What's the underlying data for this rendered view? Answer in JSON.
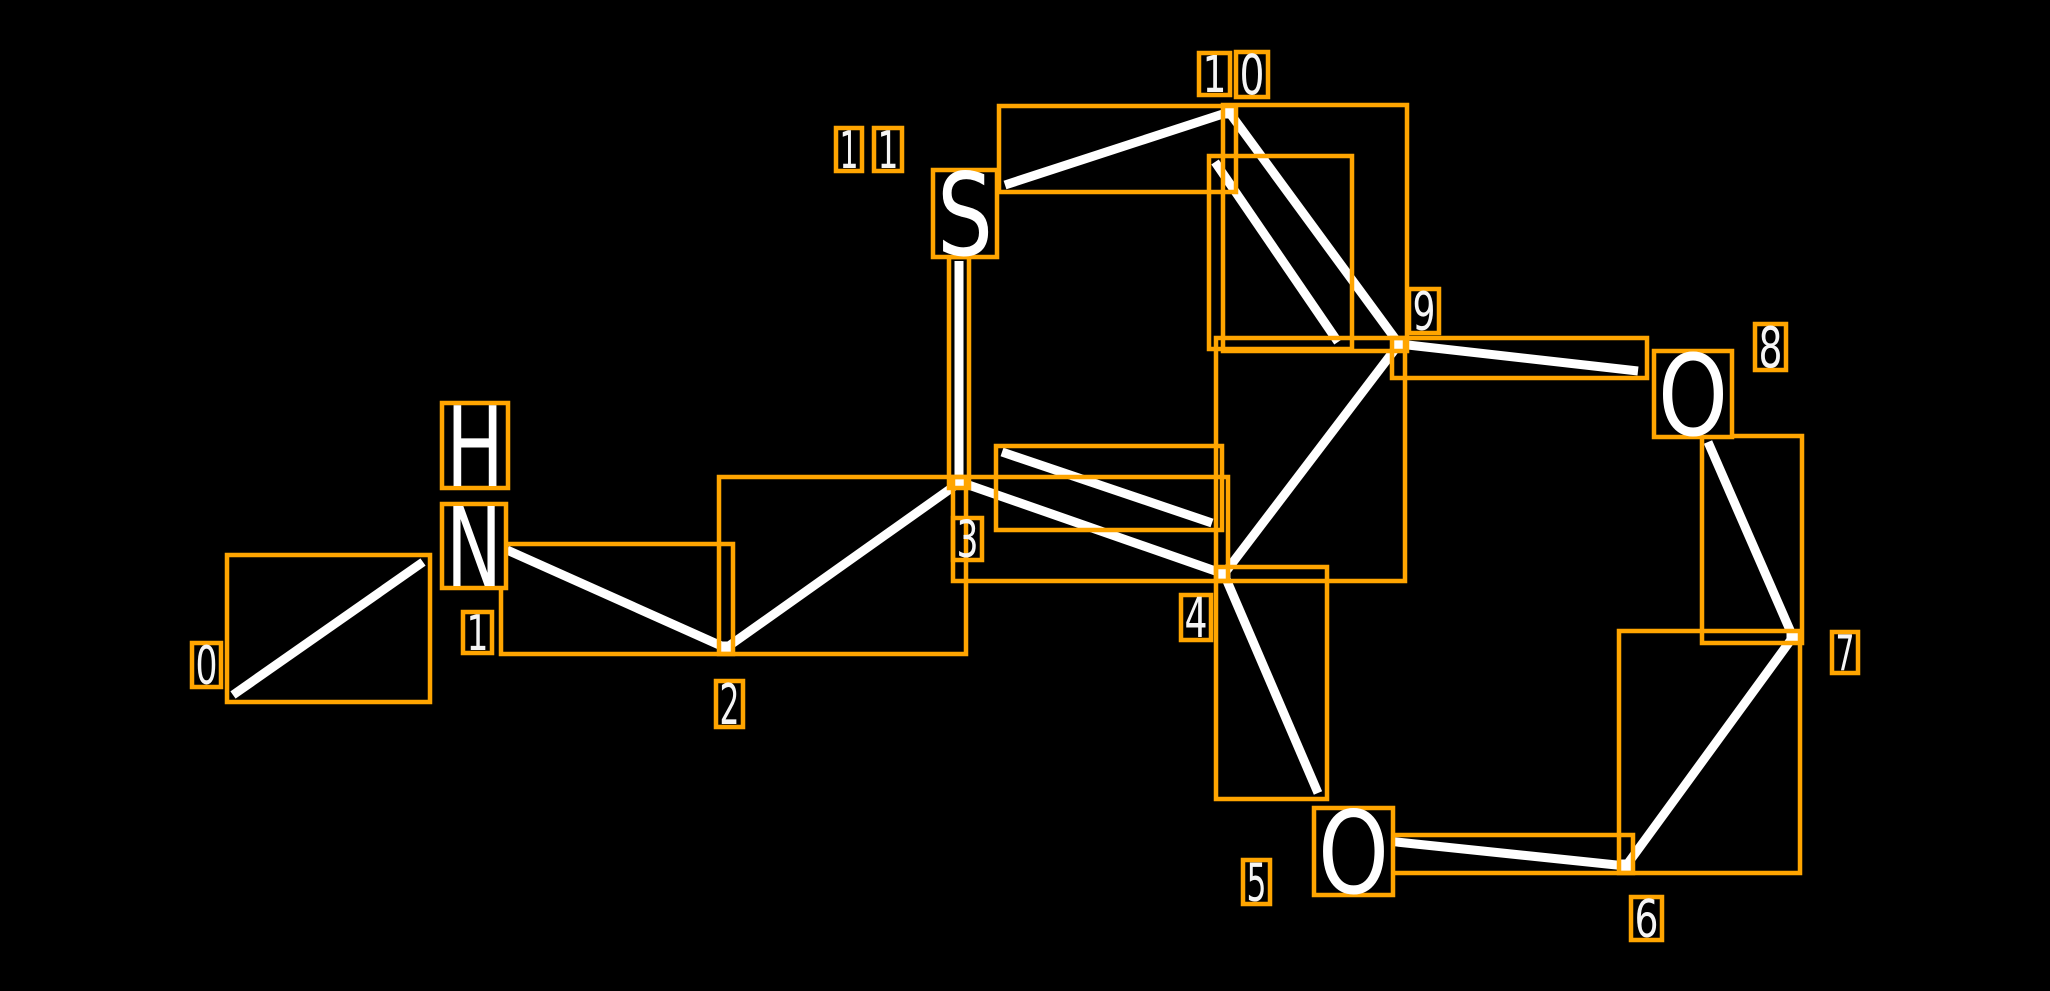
{
  "canvas": {
    "width": 2050,
    "height": 991,
    "background": "#000000"
  },
  "colors": {
    "background": "#000000",
    "bond": "#ffffff",
    "annotation_box": "#ffa500",
    "atom_label": "#ffffff",
    "index_label": "#f5f5f5"
  },
  "style": {
    "bond_stroke_width": 9,
    "box_stroke_width": 4.5,
    "vertex_marker_size": 13
  },
  "molecule": {
    "description": "2D molecular structure drawing with per-bond orange bounding boxes and white atom-index labels 0-11",
    "atoms": [
      {
        "index": 0,
        "element": "C",
        "x": 233,
        "y": 695
      },
      {
        "index": 1,
        "element": "N",
        "x": 474,
        "y": 546,
        "shown_as": "HN"
      },
      {
        "index": 2,
        "element": "C",
        "x": 726,
        "y": 648
      },
      {
        "index": 3,
        "element": "C",
        "x": 960,
        "y": 483
      },
      {
        "index": 4,
        "element": "C",
        "x": 1224,
        "y": 574
      },
      {
        "index": 5,
        "element": "O",
        "x": 1354,
        "y": 851,
        "shown_as": "O"
      },
      {
        "index": 6,
        "element": "C",
        "x": 1626,
        "y": 866
      },
      {
        "index": 7,
        "element": "C",
        "x": 1793,
        "y": 637
      },
      {
        "index": 8,
        "element": "O",
        "x": 1693,
        "y": 394,
        "shown_as": "O"
      },
      {
        "index": 9,
        "element": "C",
        "x": 1399,
        "y": 344
      },
      {
        "index": 10,
        "element": "C",
        "x": 1229,
        "y": 112
      },
      {
        "index": 11,
        "element": "S",
        "x": 965,
        "y": 213,
        "shown_as": "S"
      }
    ],
    "bonds": [
      {
        "from": 0,
        "to": 1,
        "order": "single"
      },
      {
        "from": 1,
        "to": 2,
        "order": "single"
      },
      {
        "from": 2,
        "to": 3,
        "order": "single"
      },
      {
        "from": 3,
        "to": 11,
        "order": "single"
      },
      {
        "from": 3,
        "to": 4,
        "order": "double"
      },
      {
        "from": 11,
        "to": 10,
        "order": "single"
      },
      {
        "from": 10,
        "to": 9,
        "order": "double"
      },
      {
        "from": 9,
        "to": 4,
        "order": "single"
      },
      {
        "from": 9,
        "to": 8,
        "order": "single"
      },
      {
        "from": 8,
        "to": 7,
        "order": "single"
      },
      {
        "from": 7,
        "to": 6,
        "order": "single"
      },
      {
        "from": 6,
        "to": 5,
        "order": "single"
      },
      {
        "from": 4,
        "to": 5,
        "order": "single"
      }
    ],
    "bond_segments": [
      {
        "bond": "0-1",
        "x1": 233,
        "y1": 695,
        "x2": 423,
        "y2": 562,
        "box": [
          227,
          555,
          203,
          147
        ]
      },
      {
        "bond": "1-2",
        "x1": 507,
        "y1": 550,
        "x2": 726,
        "y2": 648,
        "box": [
          501,
          544,
          232,
          110
        ]
      },
      {
        "bond": "2-3",
        "x1": 726,
        "y1": 648,
        "x2": 960,
        "y2": 482,
        "box": [
          719,
          477,
          247,
          177
        ]
      },
      {
        "bond": "3-11",
        "x1": 959,
        "y1": 483,
        "x2": 959,
        "y2": 261,
        "box": [
          949,
          257,
          20,
          231
        ]
      },
      {
        "bond": "3-4-main",
        "x1": 960,
        "y1": 482,
        "x2": 1224,
        "y2": 574,
        "box": [
          953,
          477,
          275,
          104
        ]
      },
      {
        "bond": "3-4-inner",
        "x1": 1002,
        "y1": 452,
        "x2": 1212,
        "y2": 523,
        "box": [
          996,
          446,
          226,
          84
        ]
      },
      {
        "bond": "11-10",
        "x1": 1005,
        "y1": 185,
        "x2": 1229,
        "y2": 112,
        "box": [
          999,
          106,
          237,
          86
        ]
      },
      {
        "bond": "10-9-main",
        "x1": 1229,
        "y1": 112,
        "x2": 1399,
        "y2": 344,
        "box": [
          1223,
          105,
          184,
          246
        ]
      },
      {
        "bond": "10-9-inner",
        "x1": 1215,
        "y1": 162,
        "x2": 1338,
        "y2": 342,
        "box": [
          1209,
          156,
          143,
          193
        ]
      },
      {
        "bond": "9-4",
        "x1": 1399,
        "y1": 344,
        "x2": 1224,
        "y2": 574,
        "box": [
          1216,
          338,
          189,
          243
        ]
      },
      {
        "bond": "9-8",
        "x1": 1399,
        "y1": 344,
        "x2": 1638,
        "y2": 371,
        "box": [
          1392,
          338,
          255,
          40
        ]
      },
      {
        "bond": "8-7",
        "x1": 1708,
        "y1": 442,
        "x2": 1793,
        "y2": 637,
        "box": [
          1702,
          436,
          100,
          207
        ]
      },
      {
        "bond": "7-6",
        "x1": 1793,
        "y1": 637,
        "x2": 1626,
        "y2": 866,
        "box": [
          1619,
          631,
          181,
          242
        ]
      },
      {
        "bond": "6-5",
        "x1": 1626,
        "y1": 866,
        "x2": 1387,
        "y2": 841,
        "box": [
          1380,
          835,
          253,
          38
        ]
      },
      {
        "bond": "4-5",
        "x1": 1224,
        "y1": 574,
        "x2": 1318,
        "y2": 793,
        "box": [
          1216,
          567,
          111,
          232
        ]
      }
    ],
    "vertex_markers": [
      {
        "atom": 2,
        "x": 726,
        "y": 648
      },
      {
        "atom": 3,
        "x": 960,
        "y": 483
      },
      {
        "atom": 4,
        "x": 1224,
        "y": 574
      },
      {
        "atom": 6,
        "x": 1626,
        "y": 866
      },
      {
        "atom": 7,
        "x": 1793,
        "y": 637
      },
      {
        "atom": 9,
        "x": 1399,
        "y": 344
      },
      {
        "atom": 10,
        "x": 1229,
        "y": 112
      }
    ],
    "atom_glyphs": [
      {
        "atom": 1,
        "text": "H",
        "box": [
          442,
          403,
          66,
          85
        ]
      },
      {
        "atom": 1,
        "text": "N",
        "box": [
          442,
          504,
          64,
          84
        ]
      },
      {
        "atom": 11,
        "text": "S",
        "box": [
          933,
          170,
          64,
          87
        ]
      },
      {
        "atom": 5,
        "text": "O",
        "box": [
          1314,
          808,
          79,
          87
        ]
      },
      {
        "atom": 8,
        "text": "O",
        "box": [
          1654,
          351,
          78,
          86
        ]
      }
    ],
    "index_labels": [
      {
        "label": "0",
        "digits": [
          {
            "char": "0",
            "box": [
              192,
              643,
              29,
              44
            ]
          }
        ]
      },
      {
        "label": "1",
        "digits": [
          {
            "char": "1",
            "box": [
              463,
              612,
              29,
              41
            ]
          }
        ]
      },
      {
        "label": "2",
        "digits": [
          {
            "char": "2",
            "box": [
              716,
              681,
              27,
              46
            ]
          }
        ]
      },
      {
        "label": "3",
        "digits": [
          {
            "char": "3",
            "box": [
              953,
              518,
              29,
              42
            ]
          }
        ]
      },
      {
        "label": "4",
        "digits": [
          {
            "char": "4",
            "box": [
              1181,
              595,
              30,
              45
            ]
          }
        ]
      },
      {
        "label": "5",
        "digits": [
          {
            "char": "5",
            "box": [
              1243,
              860,
              27,
              44
            ]
          }
        ]
      },
      {
        "label": "6",
        "digits": [
          {
            "char": "6",
            "box": [
              1631,
              897,
              31,
              43
            ]
          }
        ]
      },
      {
        "label": "7",
        "digits": [
          {
            "char": "7",
            "box": [
              1832,
              632,
              26,
              41
            ]
          }
        ]
      },
      {
        "label": "8",
        "digits": [
          {
            "char": "8",
            "box": [
              1755,
              324,
              31,
              46
            ]
          }
        ]
      },
      {
        "label": "9",
        "digits": [
          {
            "char": "9",
            "box": [
              1409,
              289,
              30,
              44
            ]
          }
        ]
      },
      {
        "label": "10",
        "digits": [
          {
            "char": "1",
            "box": [
              1199,
              53,
              31,
              42
            ]
          },
          {
            "char": "0",
            "box": [
              1236,
              52,
              32,
              45
            ]
          }
        ]
      },
      {
        "label": "11",
        "digits": [
          {
            "char": "1",
            "box": [
              836,
              128,
              26,
              43
            ]
          },
          {
            "char": "1",
            "box": [
              874,
              128,
              28,
              43
            ]
          }
        ]
      }
    ]
  }
}
